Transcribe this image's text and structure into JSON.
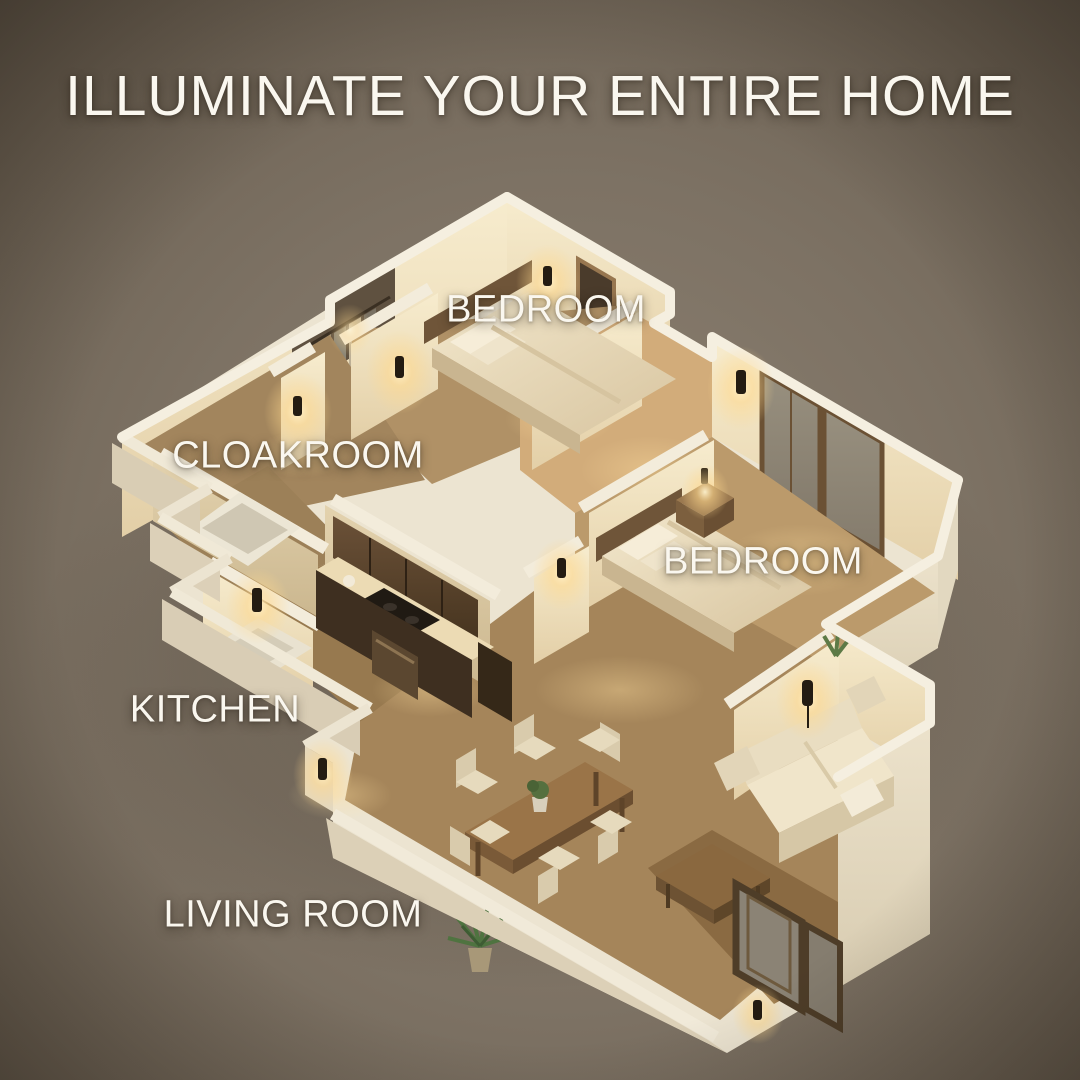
{
  "title": "ILLUMINATE YOUR ENTIRE HOME",
  "rooms": [
    {
      "id": "bedroom-top",
      "label": "BEDROOM"
    },
    {
      "id": "cloakroom",
      "label": "CLOAKROOM"
    },
    {
      "id": "bedroom-right",
      "label": "BEDROOM"
    },
    {
      "id": "kitchen",
      "label": "KITCHEN"
    },
    {
      "id": "living-room",
      "label": "LIVING ROOM"
    }
  ],
  "scene": {
    "type": "isometric-floor-plan-render",
    "lighting": "warm wall sconces, dim ambient",
    "colors": {
      "backdrop": "#7b7064",
      "backdrop_dark": "#5e5448",
      "wall_white": "#efe7d4",
      "wall_lit": "#f6e8c6",
      "wall_shade": "#d9c7a3",
      "floor_wood": "#b59266",
      "floor_lit": "#d9b988",
      "cabinet_wood": "#523d28",
      "glow": "#ffd98e",
      "glow_core": "#fff3cf",
      "text": "#faf7ef"
    }
  }
}
